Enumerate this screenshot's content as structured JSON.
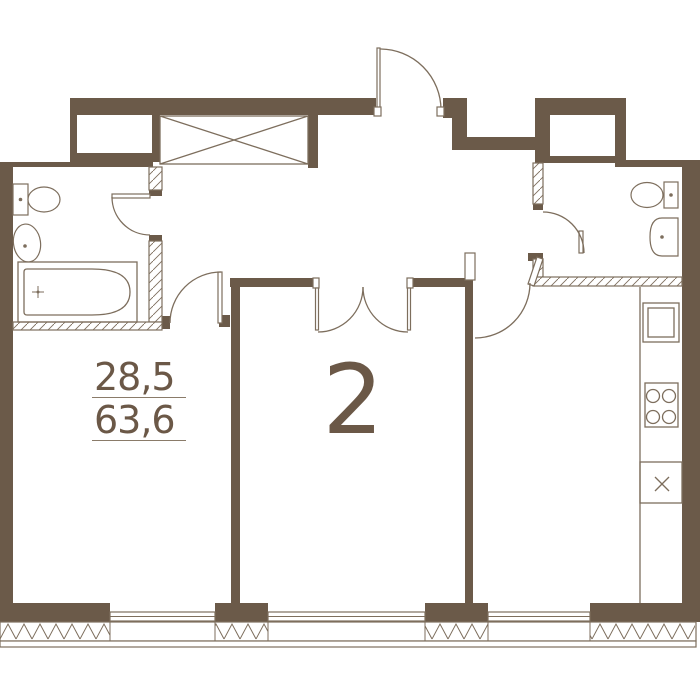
{
  "plan": {
    "rooms_count": "2",
    "living_area": "28,5",
    "total_area": "63,6"
  },
  "colors": {
    "wall": "#6b5a49",
    "line": "#7d6e5d",
    "text": "#6b5847",
    "background": "#ffffff"
  },
  "fixtures": {
    "bathroom_left": [
      "toilet-icon",
      "sink-icon",
      "bathtub-icon"
    ],
    "bathroom_right": [
      "toilet-icon",
      "sink-icon"
    ],
    "kitchen": [
      "kitchen-sink-icon",
      "stove-icon",
      "appliance-place-icon"
    ],
    "hallway": [
      "wardrobe-icon"
    ],
    "doors": [
      "entrance-door",
      "bathroom-left-door",
      "left-room-door",
      "double-door",
      "kitchen-door",
      "bathroom-right-door"
    ],
    "windows_count": 3
  }
}
